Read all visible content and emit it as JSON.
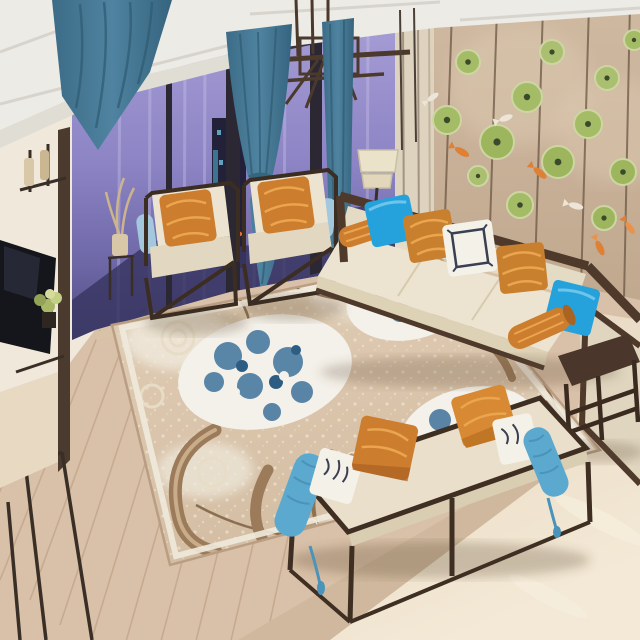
{
  "meta": {
    "title": "Living room product photo — floral area rug in a modern Chinese style lounge",
    "view": "elevated three-quarter interior view, no visible text"
  },
  "palette": {
    "ceiling": "#edebe5",
    "ceiling_shadow": "#d7d4cd",
    "chandelier": "#4b392c",
    "left_wall": "#efe8db",
    "cabinet_cream": "#e7d9c2",
    "tv_screen": "#15161c",
    "trim_dark": "#3a2f26",
    "window_top": "#a89fd7",
    "window_mid": "#8279bd",
    "window_dark": "#413e6e",
    "tower_dark": "#23203a",
    "window_frame": "#2b2733",
    "city_warm": "#e8a44c",
    "city_cool": "#57c8e8",
    "curtain": "#4a7d98",
    "curtain_dark": "#35657f",
    "pilaster": "#ddd3bf",
    "accent_wall": "#c9b299",
    "accent_seam": "#6b5844",
    "lotus_green": "#a4bc66",
    "lotus_rim": "#cdd6a2",
    "lotus_center": "#3c4a2c",
    "koi_orange": "#df8034",
    "koi_white": "#ece5d8",
    "panel_cream": "#e6ddc8",
    "sofa_wood": "#4e392b",
    "cushion_cream": "#ece4d0",
    "cushion_shade": "#ded3ba",
    "pillow_blue": "#25a2dc",
    "pillow_orange": "#cc7d2e",
    "pillow_orange_hi": "#eaa54e",
    "pillow_white": "#f4f1e9",
    "pillow_navy": "#3a3f52",
    "bolster_blue": "#5ba9cf",
    "chair_bolster": "#a3c8dd",
    "lamp_shade": "#ebe2ca",
    "rug_base": "#dbc6ad",
    "rug_lace": "#f0eadd",
    "rug_blue": "#49799f",
    "rug_blue_dark": "#2e5d84",
    "rug_scroll": "#9b7b59",
    "rug_scroll_dark": "#7c5f42",
    "rug_leaf": "#b59a77",
    "wood_floor": "#d9c0a8",
    "wood_line": "#c3a78c",
    "tile_band": "#cfb89e",
    "marble": "#e9dcc8",
    "marble_hi": "#f7efde",
    "greenery": "#a9b866",
    "shadow": "rgba(92,72,52,0.28)"
  },
  "scene": {
    "objects": [
      {
        "name": "ceiling-beams",
        "label": "white coffered ceiling with recessed beams"
      },
      {
        "name": "chandelier",
        "label": "dark bronze rectangular pendant chandelier"
      },
      {
        "name": "corner-drape",
        "label": "teal curtain draped across the upper left corner"
      },
      {
        "name": "window-wall",
        "label": "floor-to-ceiling windows with purple night city view and lights"
      },
      {
        "name": "center-curtain",
        "label": "teal curtain tied at the waist"
      },
      {
        "name": "right-curtain",
        "label": "straight teal curtain panel"
      },
      {
        "name": "tv",
        "label": "wall mounted flat screen TV on cream media wall"
      },
      {
        "name": "media-shelf",
        "label": "dark metal shelf with plants and vases"
      },
      {
        "name": "accent-wall",
        "label": "tan paneled wall decorated with green lotus leaves and koi fish ornaments"
      },
      {
        "name": "padded-panels",
        "label": "cream upholstered wall panels behind the sofa"
      },
      {
        "name": "sofa",
        "label": "dark wood frame sofa with cream cushions and pillows"
      },
      {
        "name": "armchair-1",
        "label": "cream armchair with orange brocade pillow"
      },
      {
        "name": "armchair-2",
        "label": "cream armchair with orange brocade pillow"
      },
      {
        "name": "floor-lamp",
        "label": "floor lamp with cream drum shade"
      },
      {
        "name": "area-rug",
        "label": "beige floral area rug with blue-white peonies, brown scrolls and lace medallions"
      },
      {
        "name": "daybed-bench",
        "label": "dark wood daybed bench with cream pad, blue bolsters, orange and white pillows"
      },
      {
        "name": "side-table",
        "label": "dark wood side table on marble floor"
      },
      {
        "name": "wood-floor",
        "label": "light wood plank flooring"
      },
      {
        "name": "marble-floor",
        "label": "polished beige marble flooring"
      }
    ],
    "pillow_styles": [
      "sky blue solid",
      "orange gold brocade",
      "white with navy key-pattern border",
      "sky blue bolster with tassel",
      "orange bolster"
    ]
  }
}
